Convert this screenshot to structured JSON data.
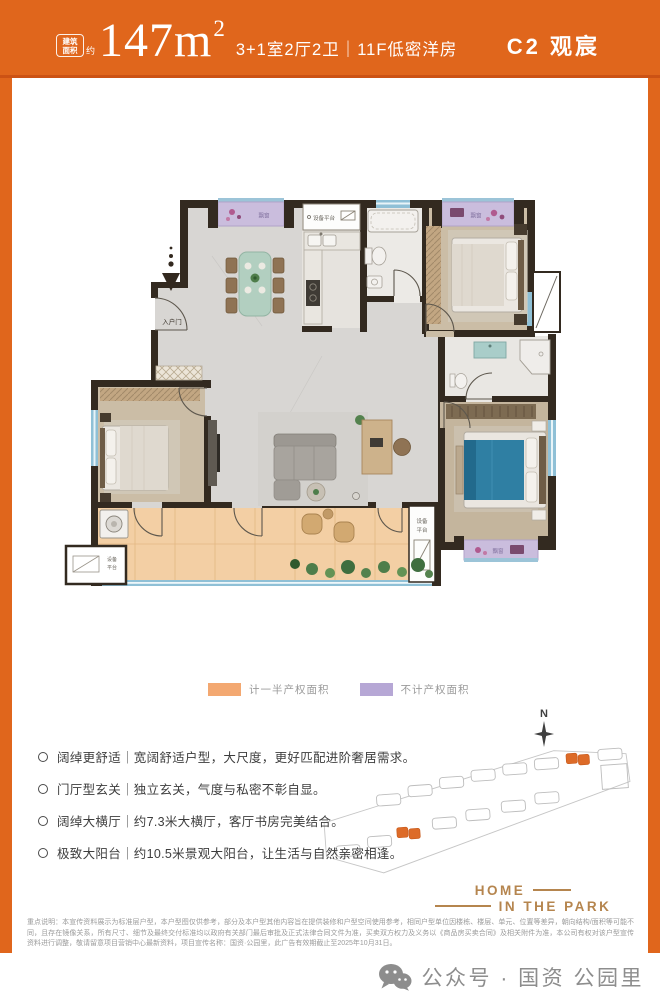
{
  "header": {
    "badge_line1": "建筑",
    "badge_line2": "面积",
    "badge_approx": "约",
    "area_value": "147m",
    "area_exponent": "2",
    "layout_info": "3+1室2厅2卫｜11F低密洋房",
    "unit_name": "C2 观宸",
    "bg_color": "#e0661c"
  },
  "plan": {
    "entry_label": "入户门",
    "equipment_platform_label": "设备平台",
    "equipment_l1": "设备",
    "equipment_l2": "平台",
    "bay_window_label": "飘窗",
    "compass_label": "N"
  },
  "legend": {
    "half_area": {
      "label": "计一半产权面积",
      "color": "#f3a871"
    },
    "excluded_area": {
      "label": "不计产权面积",
      "color": "#b6a7d5"
    }
  },
  "features": [
    "阔绰更舒适｜宽阔舒适户型，大尺度，更好匹配进阶奢居需求。",
    "门厅型玄关｜独立玄关，气度与私密不彰自显。",
    "阔绰大横厅｜约7.3米大横厅，客厅书房完美结合。",
    "极致大阳台｜约10.5米景观大阳台，让生活与自然亲密相逢。"
  ],
  "brand": {
    "line1": "HOME",
    "line2": "IN THE PARK"
  },
  "disclaimer": "重点说明：本宣传资料展示为标准层户型，本户型图仅供参考，部分及本户型其他内容旨在提供装修和户型空间使用参考，相同户型单位因楼栋、楼层、单元、位置等差异，朝向结构/面积等可能不同，且存在镜像关系，所有尺寸、细节及最终交付标准均以政府有关部门最后审批及正式法律合同文件为准，买卖双方权力及义务以《商品房买卖合同》及相关附件为准，本公司有权对该户型宣传资料进行调整，敬请留意项目营销中心最新资料，项目宣传名称：国资·公园里，此广告有效期截止至2025年10月31日。",
  "footer": {
    "label": "公众号 · 国资 公园里"
  }
}
